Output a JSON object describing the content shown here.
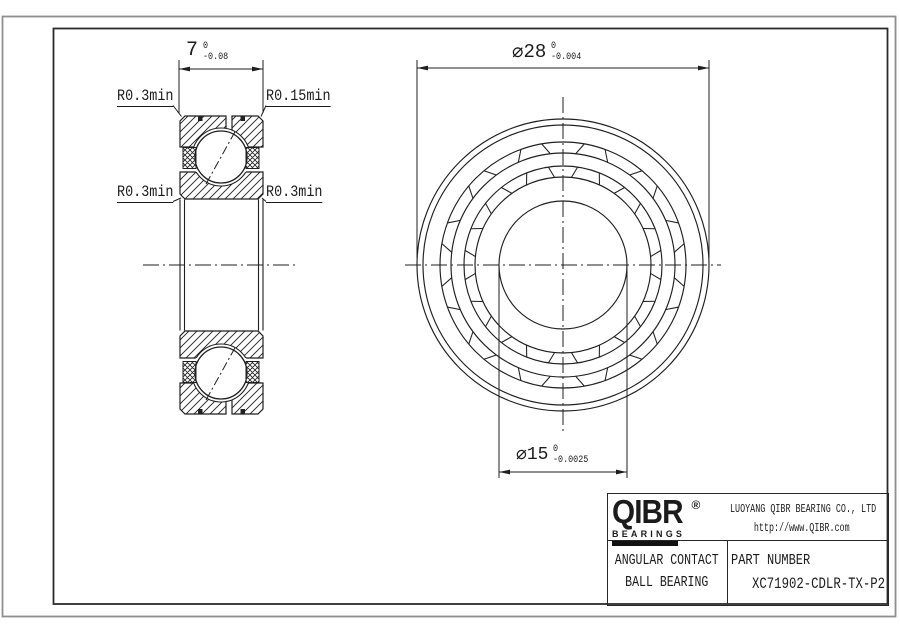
{
  "meta": {
    "background": "#ffffff",
    "line_color": "#1f1f1f",
    "frame_outer_color": "#8f8f8f",
    "frame_inner_color": "#2b2b2b",
    "text_color": "#1b1b1b"
  },
  "dims": {
    "width": {
      "value": "7",
      "tol_upper": "0",
      "tol_lower": "-0.08"
    },
    "outer_diameter": {
      "symbol": "⌀",
      "value": "28",
      "tol_upper": "0",
      "tol_lower": "-0.004"
    },
    "bore_diameter": {
      "symbol": "⌀",
      "value": "15",
      "tol_upper": "0",
      "tol_lower": "-0.0025"
    }
  },
  "radius_labels": {
    "top_left": "R0.3min",
    "top_right": "R0.15min",
    "mid_left": "R0.3min",
    "mid_right": "R0.3min"
  },
  "title_block": {
    "logo": {
      "name": "QIBR",
      "registered": "®",
      "subtitle": "BEARINGS"
    },
    "company_line1": "LUOYANG QIBR BEARING CO., LTD",
    "company_line2": "http://www.QIBR.com",
    "product_line1": "ANGULAR CONTACT",
    "product_line2": "BALL BEARING",
    "part_number_label": "PART NUMBER",
    "part_number_value": "XC71902-CDLR-TX-P2"
  }
}
